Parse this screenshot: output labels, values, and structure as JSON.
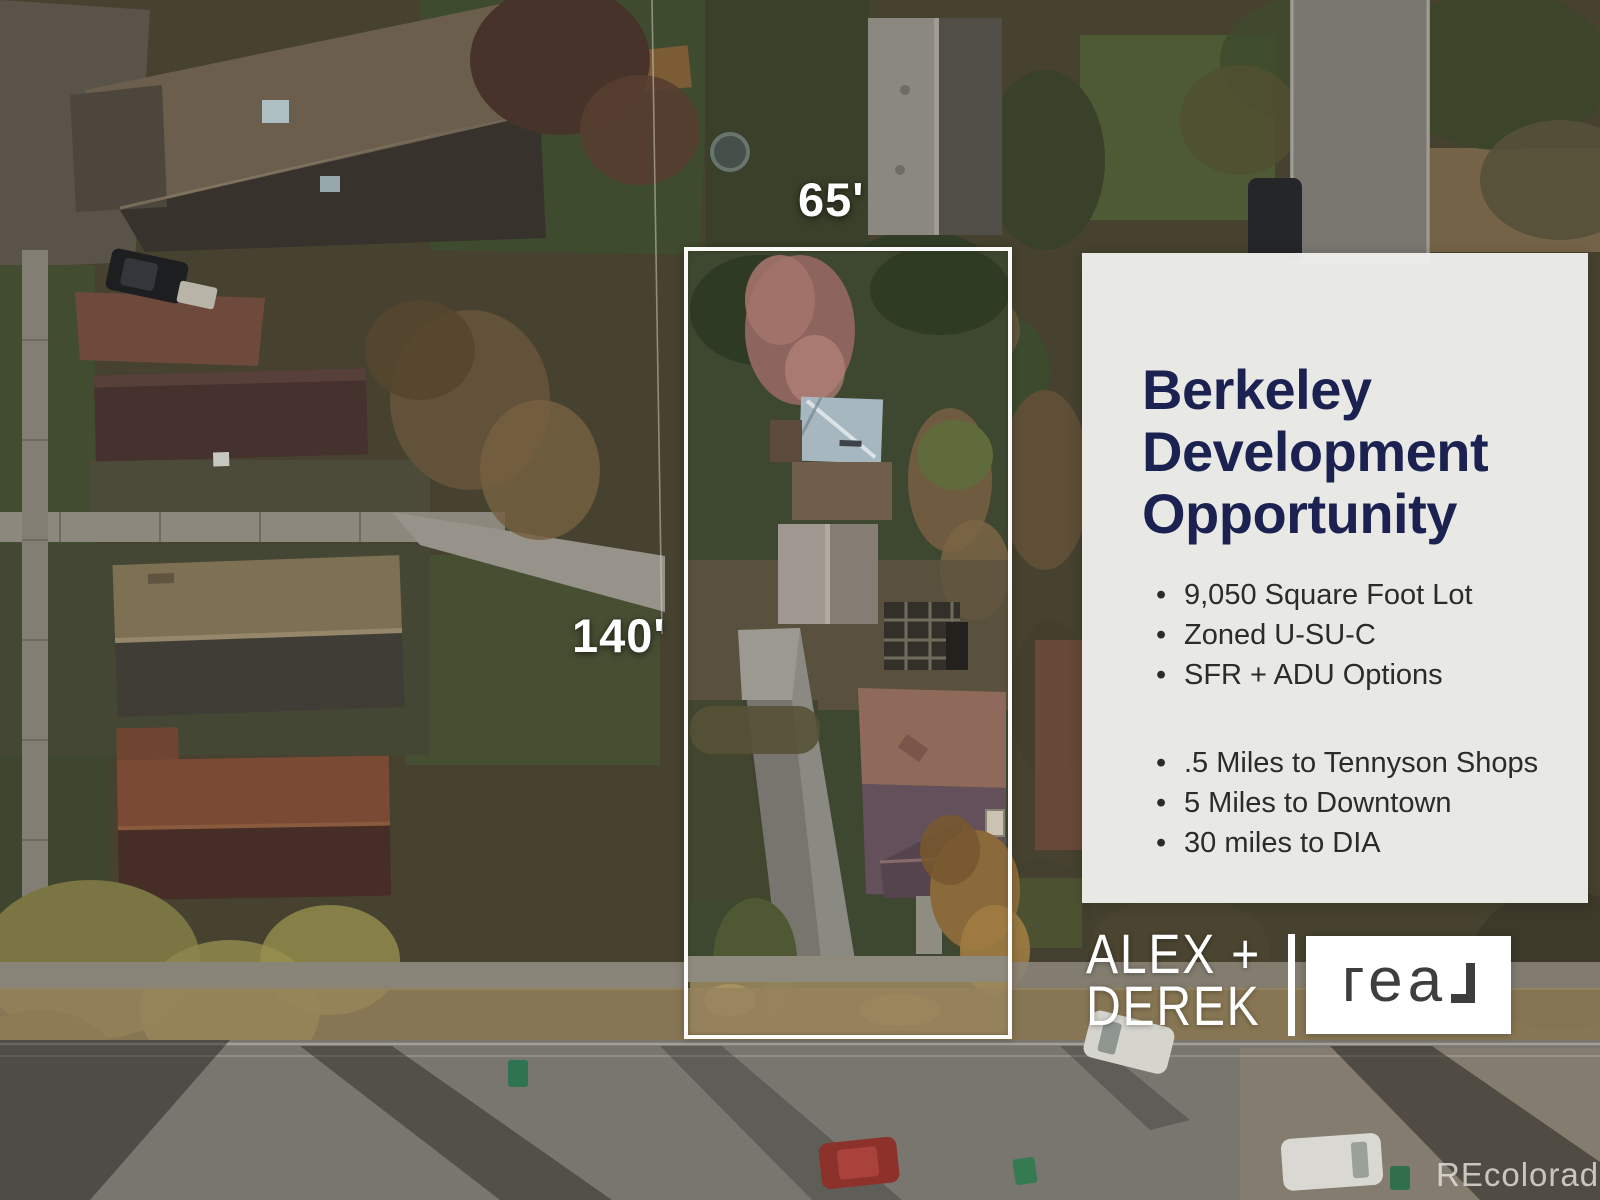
{
  "lot": {
    "width_label": "65'",
    "depth_label": "140'",
    "outline_color": "#ffffff"
  },
  "card": {
    "title_lines": [
      "Berkeley",
      "Development",
      "Opportunity"
    ],
    "bullets_primary": [
      "9,050 Square Foot Lot",
      "Zoned U-SU-C",
      "SFR + ADU Options"
    ],
    "bullets_secondary": [
      ".5 Miles to Tennyson Shops",
      "5 Miles to Downtown",
      "30 miles to DIA"
    ],
    "colors": {
      "title": "#1b2150",
      "background": "#edeeea",
      "body_text": "#2b2b2b"
    }
  },
  "branding": {
    "agent_line1": "ALEX +",
    "agent_line2": "DEREK",
    "brokerage_name": "real",
    "logo_glyphs": "геа",
    "colors": {
      "agent_text": "#ffffff",
      "logo_box": "#ffffff",
      "logo_text": "#3e3e3e"
    }
  },
  "watermark": {
    "text": "REcolorado"
  }
}
